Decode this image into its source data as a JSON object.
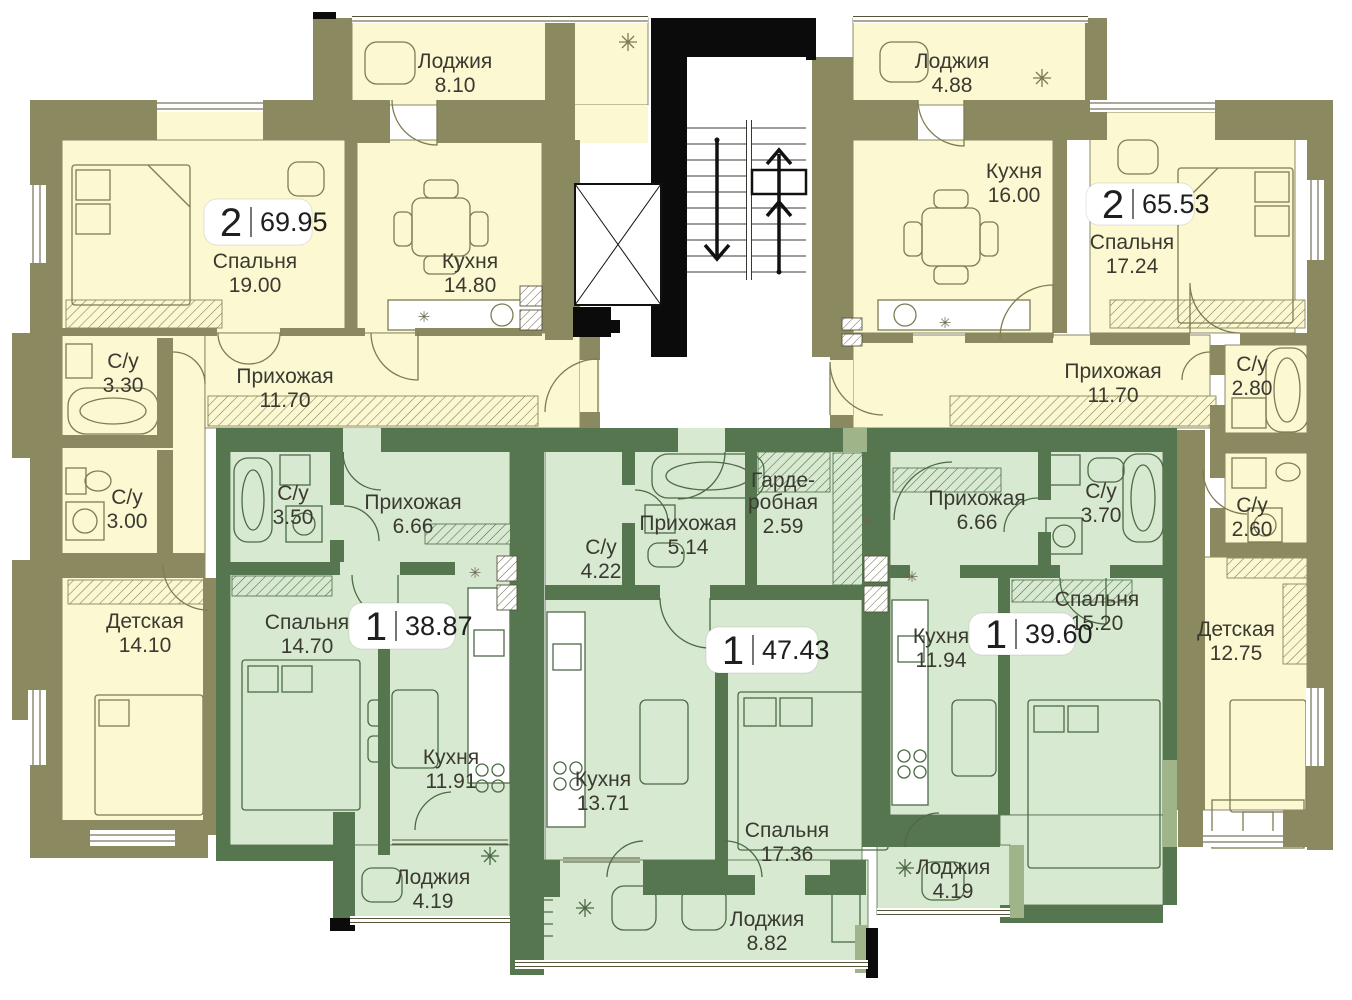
{
  "palette": {
    "wall_olive": "#8B895F",
    "room_yellow": "#FBF8D2",
    "wall_green": "#567650",
    "room_green": "#D8E9D1",
    "wall_sage": "#9FB489",
    "core_black": "#0B0B0B",
    "badge_bg": "#FFFFFF",
    "label_text": "#3A3A30"
  },
  "icons": {
    "washer-icon": "✳"
  },
  "apartments": [
    {
      "id": "a",
      "type_label": "2",
      "total_area": "69.95",
      "rooms": [
        {
          "key": "loggia",
          "name": "Лоджия",
          "area": "8.10"
        },
        {
          "key": "bedroom",
          "name": "Спальня",
          "area": "19.00"
        },
        {
          "key": "kitchen",
          "name": "Кухня",
          "area": "14.80"
        },
        {
          "key": "hallway",
          "name": "Прихожая",
          "area": "11.70"
        },
        {
          "key": "wc1",
          "name": "С/у",
          "area": "3.30"
        },
        {
          "key": "wc2",
          "name": "С/у",
          "area": "3.00"
        },
        {
          "key": "kids",
          "name": "Детская",
          "area": "14.10"
        }
      ]
    },
    {
      "id": "b",
      "type_label": "2",
      "total_area": "65.53",
      "rooms": [
        {
          "key": "loggia",
          "name": "Лоджия",
          "area": "4.88"
        },
        {
          "key": "kitchen",
          "name": "Кухня",
          "area": "16.00"
        },
        {
          "key": "bedroom",
          "name": "Спальня",
          "area": "17.24"
        },
        {
          "key": "hallway",
          "name": "Прихожая",
          "area": "11.70"
        },
        {
          "key": "wc1",
          "name": "С/у",
          "area": "2.80"
        },
        {
          "key": "wc2",
          "name": "С/у",
          "area": "2.60"
        },
        {
          "key": "kids",
          "name": "Детская",
          "area": "12.75"
        }
      ]
    },
    {
      "id": "c",
      "type_label": "1",
      "total_area": "38.87",
      "rooms": [
        {
          "key": "wc",
          "name": "С/у",
          "area": "3.50"
        },
        {
          "key": "hallway",
          "name": "Прихожая",
          "area": "6.66"
        },
        {
          "key": "bedroom",
          "name": "Спальня",
          "area": "14.70"
        },
        {
          "key": "kitchen",
          "name": "Кухня",
          "area": "11.91"
        },
        {
          "key": "loggia",
          "name": "Лоджия",
          "area": "4.19"
        }
      ]
    },
    {
      "id": "d",
      "type_label": "1",
      "total_area": "47.43",
      "rooms": [
        {
          "key": "wc",
          "name": "С/у",
          "area": "4.22"
        },
        {
          "key": "hallway",
          "name": "Прихожая",
          "area": "5.14"
        },
        {
          "key": "wardrobe",
          "name": "Гарде-\nробная",
          "area": "2.59"
        },
        {
          "key": "kitchen",
          "name": "Кухня",
          "area": "13.71"
        },
        {
          "key": "bedroom",
          "name": "Спальня",
          "area": "17.36"
        },
        {
          "key": "loggia",
          "name": "Лоджия",
          "area": "8.82"
        }
      ]
    },
    {
      "id": "e",
      "type_label": "1",
      "total_area": "39.60",
      "rooms": [
        {
          "key": "hallway",
          "name": "Прихожая",
          "area": "6.66"
        },
        {
          "key": "wc",
          "name": "С/у",
          "area": "3.70"
        },
        {
          "key": "kitchen",
          "name": "Кухня",
          "area": "11.94"
        },
        {
          "key": "bedroom",
          "name": "Спальня",
          "area": "15.20"
        },
        {
          "key": "loggia",
          "name": "Лоджия",
          "area": "4.19"
        }
      ]
    }
  ]
}
